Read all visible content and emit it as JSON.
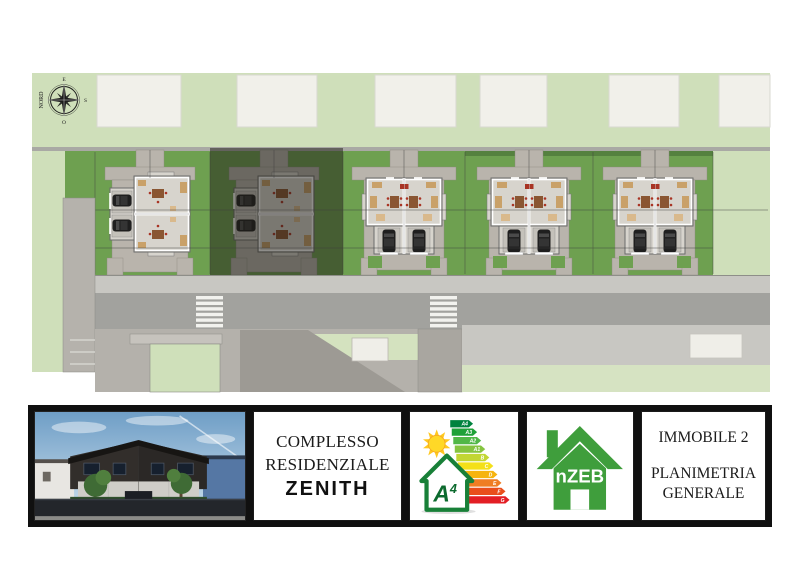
{
  "plan": {
    "compass": {
      "north": "NORD",
      "east": "E",
      "south": "S",
      "west": "O"
    },
    "palette": {
      "band_green": "#cfdfba",
      "lot_green": "#6ea050",
      "hedge_green": "#55813f",
      "path_gray": "#b9b4ac",
      "road_gray": "#a2a29e",
      "sidewalk_gray": "#c8c7c2",
      "building_white": "#f1f0ea",
      "overlay_dark": "#1e1c16"
    }
  },
  "footer": {
    "project": {
      "line1": "COMPLESSO",
      "line2": "RESIDENZIALE",
      "name": "ZENITH"
    },
    "energy": {
      "classes": [
        "A4",
        "A3",
        "A2",
        "A1",
        "B",
        "C",
        "D",
        "E",
        "F",
        "G"
      ],
      "class_colors": [
        "#00833e",
        "#1fa138",
        "#51b747",
        "#85c440",
        "#c2d633",
        "#f4e019",
        "#f6b40e",
        "#ef7d23",
        "#e94e1b",
        "#e31e24"
      ],
      "house_class_letter": "A",
      "house_class_number": "4",
      "house_border": "#188038",
      "sun_color": "#ffd827"
    },
    "nzeb": {
      "label": "nZEB",
      "color": "#3f9e3c"
    },
    "info": {
      "line1": "IMMOBILE 2",
      "line2": "PLANIMETRIA",
      "line3": "GENERALE"
    }
  }
}
